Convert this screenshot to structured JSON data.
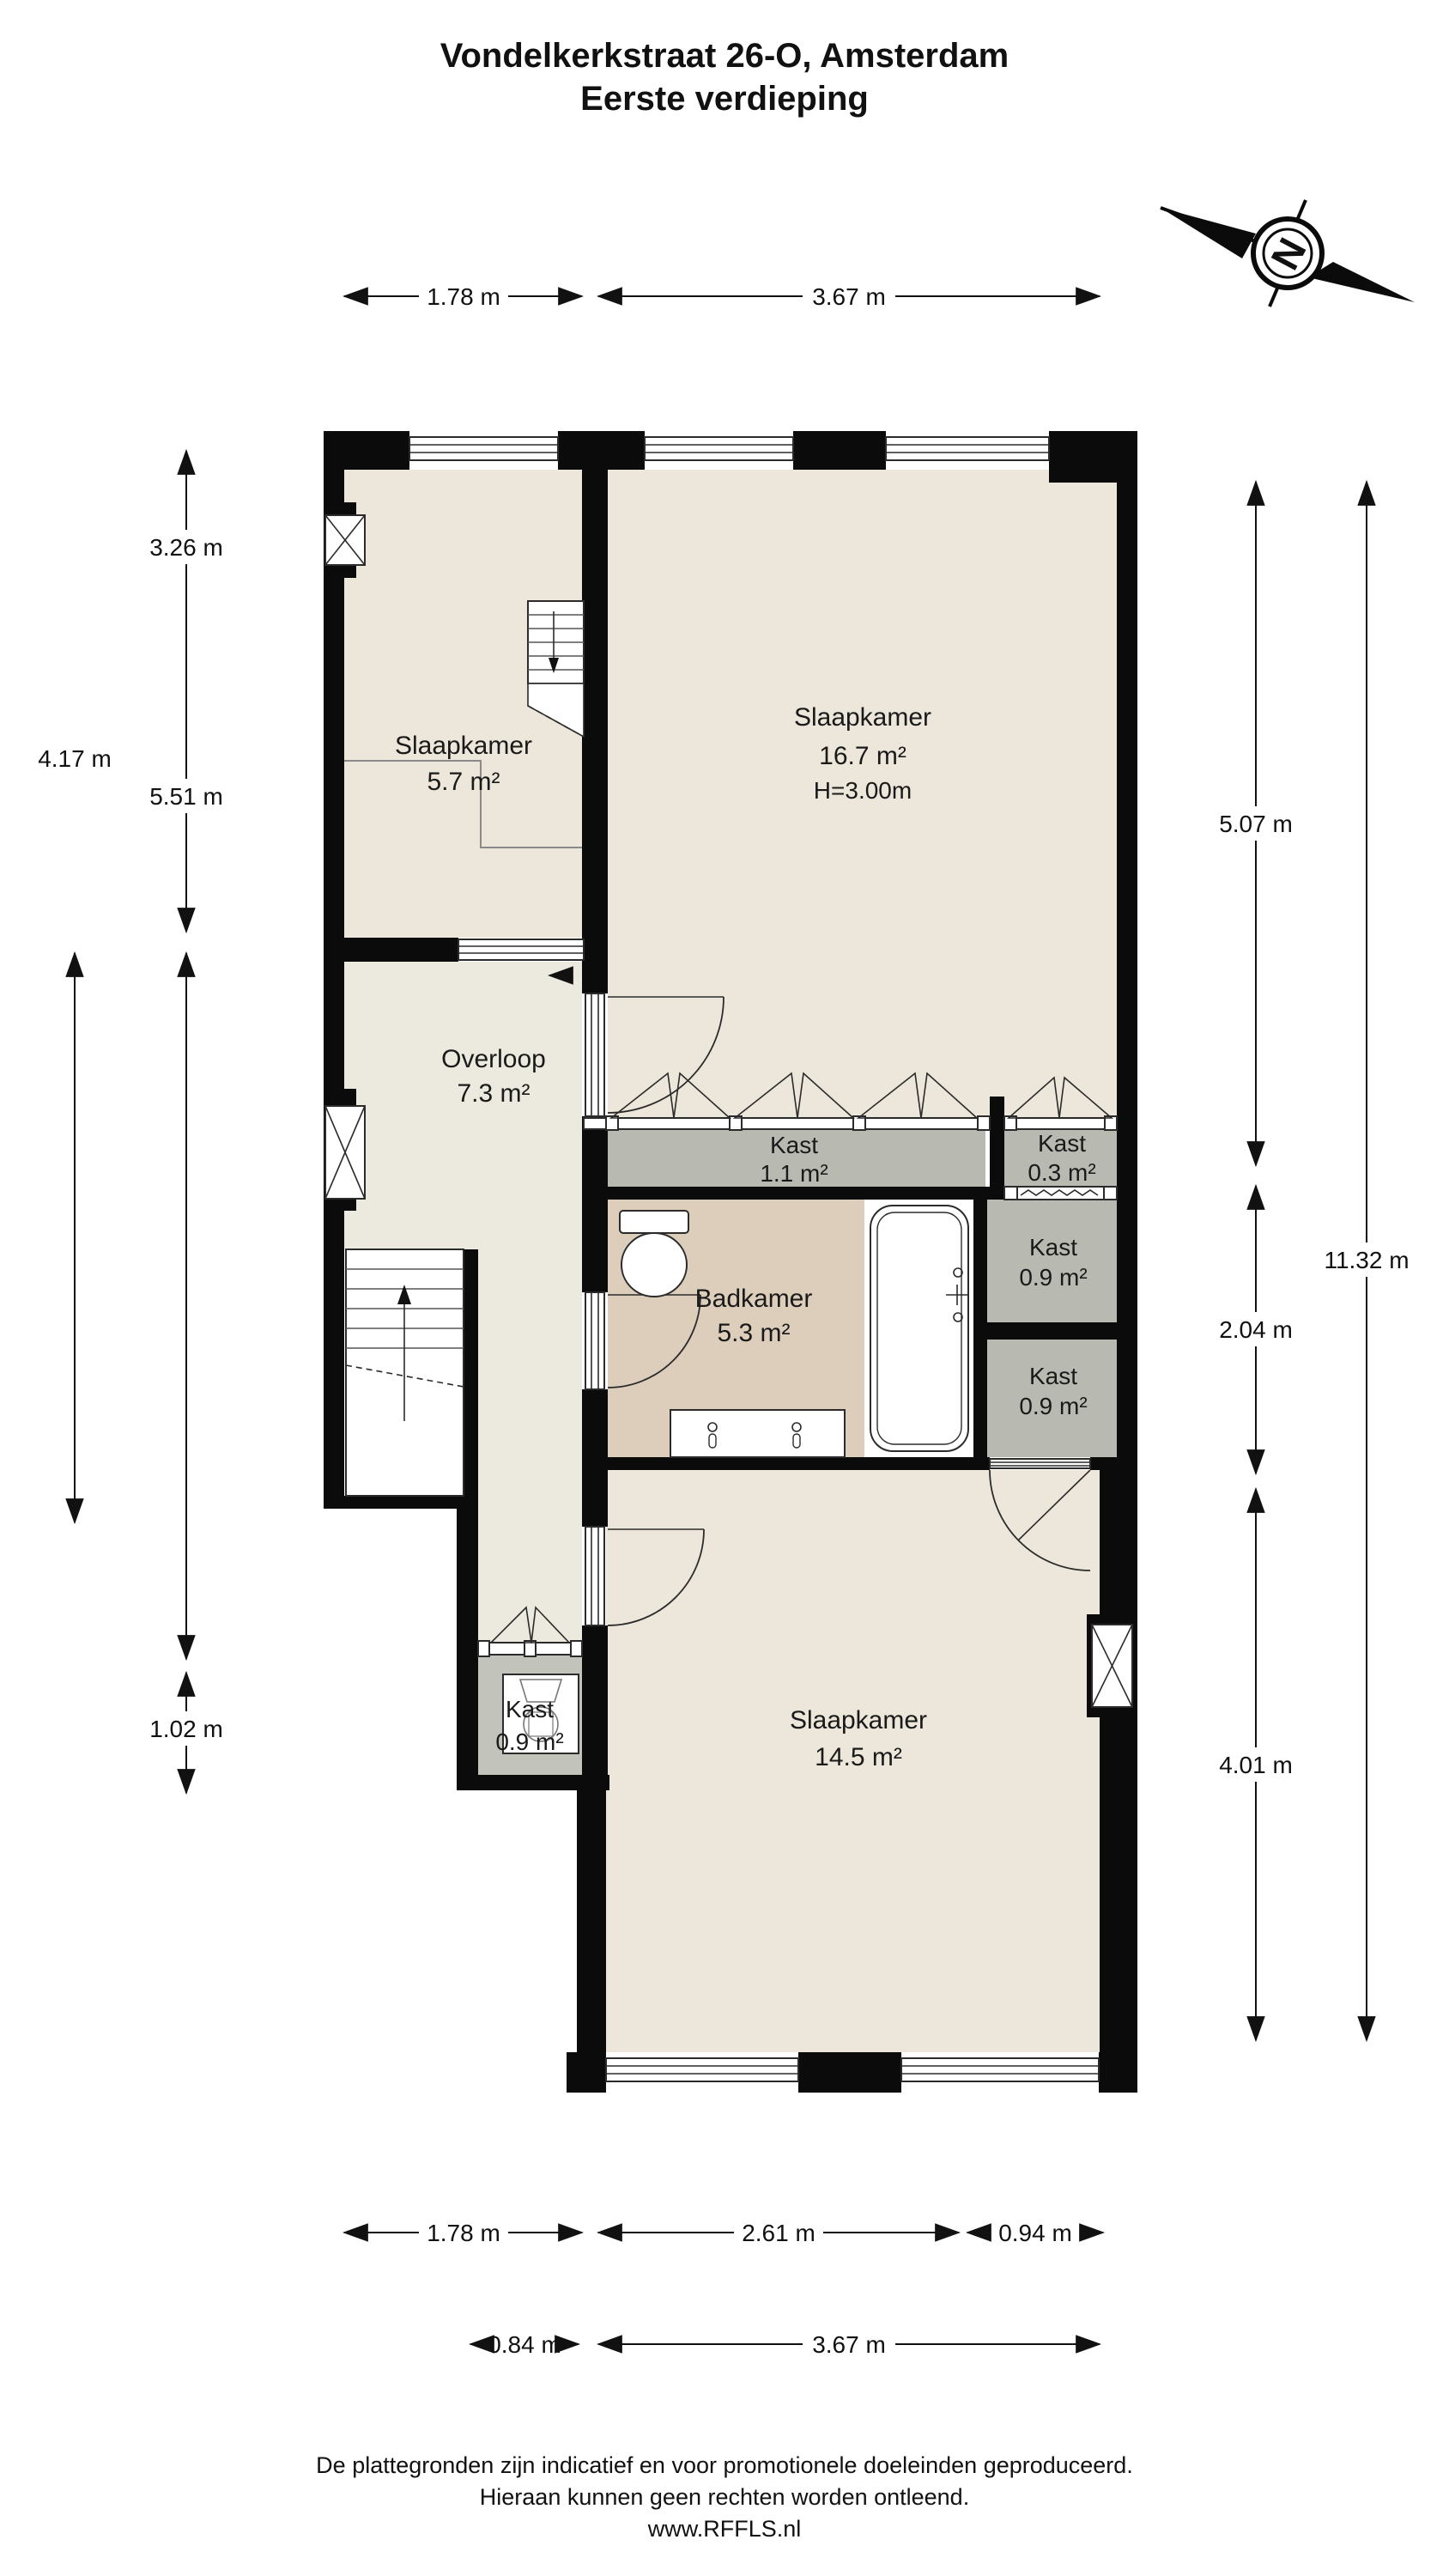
{
  "title": {
    "line1": "Vondelkerkstraat 26-O, Amsterdam",
    "line2": "Eerste verdieping"
  },
  "compass": {
    "north_label": "N"
  },
  "rooms": {
    "slaapkamer_klein": {
      "name": "Slaapkamer",
      "area": "5.7 m²"
    },
    "slaapkamer_groot": {
      "name": "Slaapkamer",
      "area": "16.7 m²",
      "ceiling_height": "H=3.00m"
    },
    "overloop": {
      "name": "Overloop",
      "area": "7.3 m²"
    },
    "badkamer": {
      "name": "Badkamer",
      "area": "5.3 m²"
    },
    "kast_11": {
      "name": "Kast",
      "area": "1.1 m²"
    },
    "kast_03": {
      "name": "Kast",
      "area": "0.3 m²"
    },
    "kast_09_rechts_boven": {
      "name": "Kast",
      "area": "0.9 m²"
    },
    "kast_09_rechts_onder": {
      "name": "Kast",
      "area": "0.9 m²"
    },
    "kast_09_links": {
      "name": "Kast",
      "area": "0.9 m²"
    },
    "slaapkamer_achter": {
      "name": "Slaapkamer",
      "area": "14.5 m²"
    }
  },
  "dimensions": {
    "top": [
      "1.78 m",
      "3.67 m"
    ],
    "left": [
      "3.26 m",
      "4.17 m",
      "5.51 m",
      "1.02 m"
    ],
    "right": [
      "5.07 m",
      "11.32 m",
      "2.04 m",
      "4.01 m"
    ],
    "bottom_row1": [
      "1.78 m",
      "2.61 m",
      "0.94 m"
    ],
    "bottom_row2": [
      "0.84 m",
      "3.67 m"
    ]
  },
  "footer": {
    "line1": "De plattegronden zijn indicatief en voor promotionele doeleinden geproduceerd.",
    "line2": "Hieraan kunnen geen rechten worden ontleend.",
    "line3": "www.RFFLS.nl"
  }
}
